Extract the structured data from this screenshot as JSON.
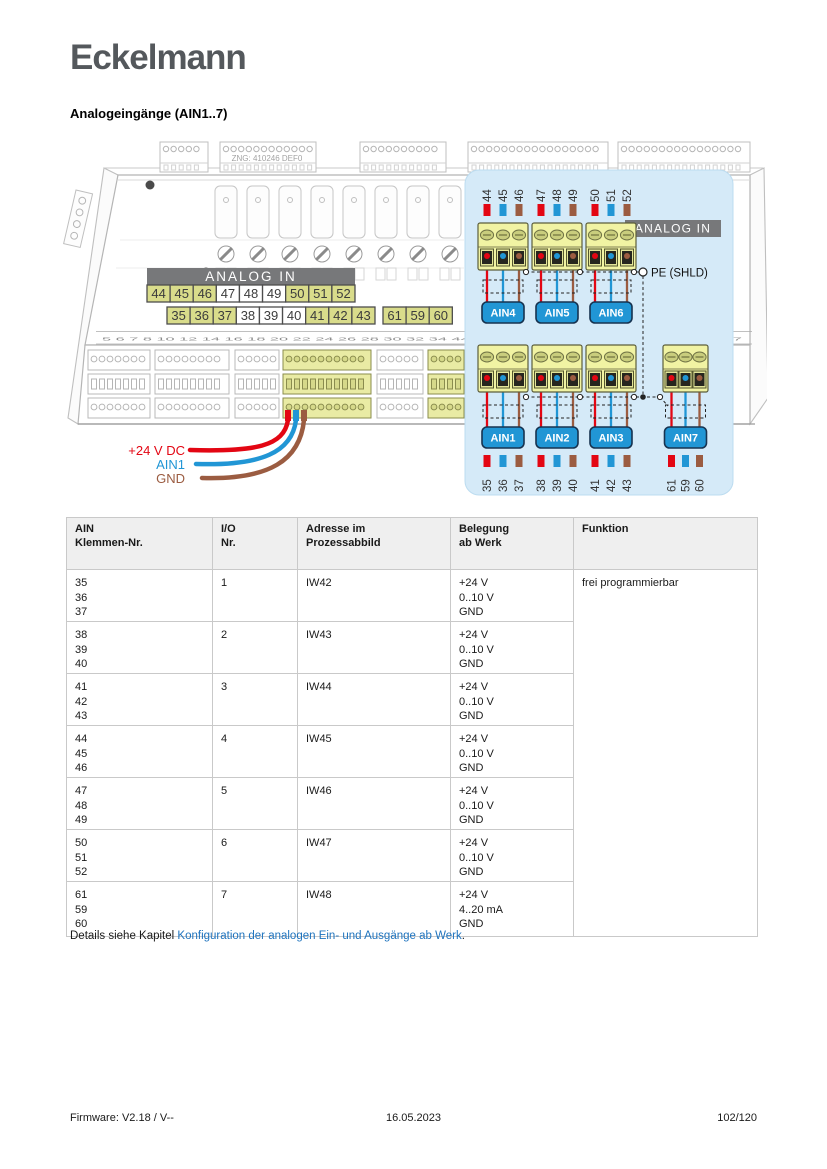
{
  "page": {
    "logo_text": "Eckelmann",
    "heading": "Analogeingänge (AIN1..7)",
    "details": {
      "prefix": "Details siehe Kapitel ",
      "link": "Konfiguration der analogen Ein- und Ausgänge ab Werk",
      "suffix": "."
    },
    "footer": {
      "left": "Firmware: V2.18 / V--",
      "center": "16.05.2023",
      "right": "102/120"
    }
  },
  "colors": {
    "red": "#e30613",
    "blue": "#2196d5",
    "brown": "#9b5c41",
    "panel": "#d5eaf8",
    "panel_border": "#bcdcf0",
    "banner": "#77787a",
    "banner_text": "#ffffff",
    "cell_yellow": "#d9dc8b",
    "cell_border": "#4d4d4d",
    "terminal_body": "#f1f3a3",
    "terminal_border": "#5c5e3c",
    "screw": "#c9cd7d",
    "socket_dark": "#26261e",
    "ain_fill": "#2196d5",
    "ain_border": "#173350",
    "link": "#1e73be",
    "logo": "#54585c",
    "sketch": "#bfbfbf"
  },
  "diagram": {
    "zng_label": "ZNG: 410246 DEF0",
    "device_banner": "ANALOG IN",
    "panel_banner": "ANALOG IN",
    "pe_label": "PE (SHLD)",
    "terminal_strip": "5 6 7 8   10 12 14 16 18 20 22 24   26 28 30 32 34   44 45 46 47 48 49 50 51 52   54 55 56 57",
    "row1": [
      {
        "label": "44",
        "yellow": true
      },
      {
        "label": "45",
        "yellow": true
      },
      {
        "label": "46",
        "yellow": true
      },
      {
        "label": "47",
        "yellow": false
      },
      {
        "label": "48",
        "yellow": false
      },
      {
        "label": "49",
        "yellow": false
      },
      {
        "label": "50",
        "yellow": true
      },
      {
        "label": "51",
        "yellow": true
      },
      {
        "label": "52",
        "yellow": true
      }
    ],
    "row2": [
      {
        "label": "35",
        "yellow": true
      },
      {
        "label": "36",
        "yellow": true
      },
      {
        "label": "37",
        "yellow": true
      },
      {
        "label": "38",
        "yellow": false
      },
      {
        "label": "39",
        "yellow": false
      },
      {
        "label": "40",
        "yellow": false
      },
      {
        "label": "41",
        "yellow": true
      },
      {
        "label": "42",
        "yellow": true
      },
      {
        "label": "43",
        "yellow": true
      }
    ],
    "row2b": [
      {
        "label": "61",
        "yellow": true
      },
      {
        "label": "59",
        "yellow": true
      },
      {
        "label": "60",
        "yellow": true
      }
    ],
    "wire_labels": [
      {
        "label": "+24 V DC",
        "color": "red"
      },
      {
        "label": "AIN1",
        "color": "blue"
      },
      {
        "label": "GND",
        "color": "brown"
      }
    ],
    "wire_cycle": [
      "red",
      "blue",
      "brown"
    ],
    "top_group": {
      "numbers": [
        "44",
        "45",
        "46",
        "47",
        "48",
        "49",
        "50",
        "51",
        "52"
      ],
      "ains": [
        "AIN4",
        "AIN5",
        "AIN6"
      ]
    },
    "bottom_group": {
      "numbers": [
        "35",
        "36",
        "37",
        "38",
        "39",
        "40",
        "41",
        "42",
        "43"
      ],
      "ains": [
        "AIN1",
        "AIN2",
        "AIN3"
      ]
    },
    "extra_group": {
      "numbers": [
        "61",
        "59",
        "60"
      ],
      "ains": [
        "AIN7"
      ]
    }
  },
  "table": {
    "headers": [
      {
        "lines": [
          "AIN",
          "Klemmen-Nr."
        ]
      },
      {
        "lines": [
          "I/O",
          "Nr."
        ]
      },
      {
        "lines": [
          "Adresse im",
          "Prozessabbild"
        ]
      },
      {
        "lines": [
          "Belegung",
          "ab Werk"
        ]
      },
      {
        "lines": [
          "Funktion"
        ]
      }
    ],
    "funktion": "frei programmierbar",
    "rows": [
      {
        "klemmen": [
          "35",
          "36",
          "37"
        ],
        "io": "1",
        "adresse": "IW42",
        "belegung": [
          "+24 V",
          "0..10 V",
          "GND"
        ]
      },
      {
        "klemmen": [
          "38",
          "39",
          "40"
        ],
        "io": "2",
        "adresse": "IW43",
        "belegung": [
          "+24 V",
          "0..10 V",
          "GND"
        ]
      },
      {
        "klemmen": [
          "41",
          "42",
          "43"
        ],
        "io": "3",
        "adresse": "IW44",
        "belegung": [
          "+24 V",
          "0..10 V",
          "GND"
        ]
      },
      {
        "klemmen": [
          "44",
          "45",
          "46"
        ],
        "io": "4",
        "adresse": "IW45",
        "belegung": [
          "+24 V",
          "0..10 V",
          "GND"
        ]
      },
      {
        "klemmen": [
          "47",
          "48",
          "49"
        ],
        "io": "5",
        "adresse": "IW46",
        "belegung": [
          "+24 V",
          "0..10 V",
          "GND"
        ]
      },
      {
        "klemmen": [
          "50",
          "51",
          "52"
        ],
        "io": "6",
        "adresse": "IW47",
        "belegung": [
          "+24 V",
          "0..10 V",
          "GND"
        ]
      },
      {
        "klemmen": [
          "61",
          "59",
          "60"
        ],
        "io": "7",
        "adresse": "IW48",
        "belegung": [
          "+24 V",
          "4..20 mA",
          "GND"
        ]
      }
    ]
  }
}
